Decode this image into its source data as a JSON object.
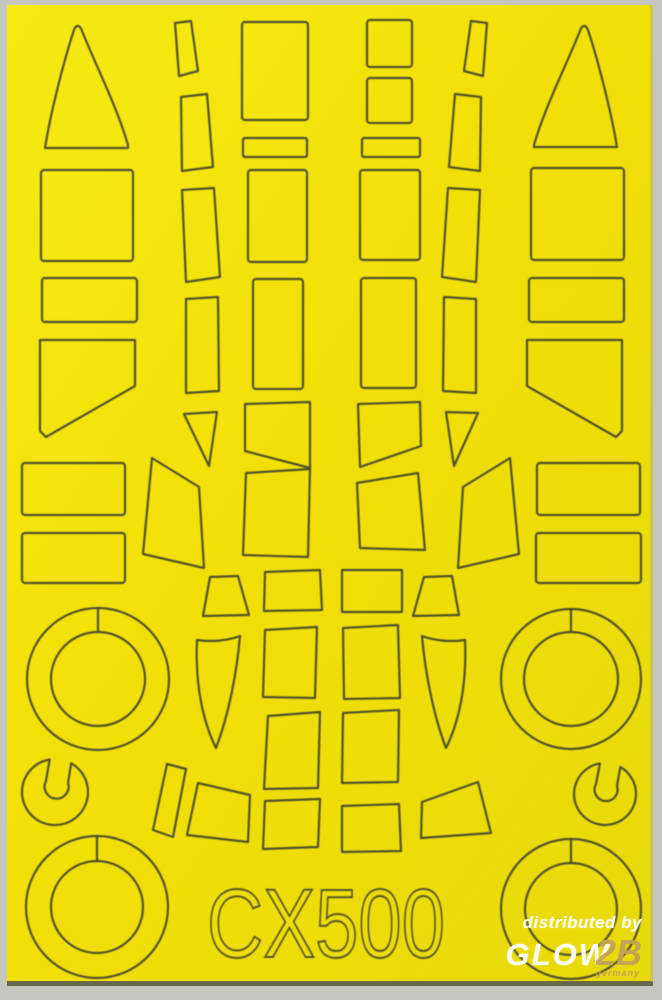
{
  "sheet": {
    "code": "CX500",
    "description": "die-cut paint mask sheet on yellow tape carrier"
  },
  "watermark": {
    "line1": "distributed by",
    "brand": "GLOW",
    "brand_suffix": "2B",
    "country": "germany"
  },
  "colors": {
    "sheet_yellow": "#f1e006",
    "sheet_yellow_light": "#f6ea14",
    "sheet_yellow_dark": "#e8d90b",
    "cut_line": "#45452c",
    "code_color": "#3e3e28",
    "scan_margin": "#c6c6c1",
    "bottom_edge": "#57573a",
    "watermark_white": "#ffffff",
    "watermark_gold": "#c2a254"
  },
  "masks": [
    {
      "name": "windscreen-triangle-left"
    },
    {
      "name": "windscreen-triangle-right"
    },
    {
      "name": "canopy-panel-rect-outer-left-1"
    },
    {
      "name": "canopy-panel-rect-outer-left-2"
    },
    {
      "name": "quarter-window-pentagon-left"
    },
    {
      "name": "fuselage-band-left-1"
    },
    {
      "name": "fuselage-band-left-2"
    },
    {
      "name": "canopy-frame-strip-left-1"
    },
    {
      "name": "canopy-frame-strip-left-2"
    },
    {
      "name": "canopy-frame-strip-left-3"
    },
    {
      "name": "canopy-frame-strip-left-4"
    },
    {
      "name": "small-triangle-left"
    },
    {
      "name": "side-glazing-quad-left"
    },
    {
      "name": "center-panel-rect-left-1"
    },
    {
      "name": "center-panel-strip-left"
    },
    {
      "name": "center-panel-rect-left-2"
    },
    {
      "name": "center-panel-rect-left-3"
    },
    {
      "name": "center-panel-slant-left"
    },
    {
      "name": "center-panel-rect-left-4"
    },
    {
      "name": "canopy-trapezoid-left"
    },
    {
      "name": "leaf-blade-mask-left"
    },
    {
      "name": "window-row1-left"
    },
    {
      "name": "window-row2-left"
    },
    {
      "name": "window-row3-left"
    },
    {
      "name": "window-row4-left"
    },
    {
      "name": "slanted-strip-bottom-left"
    },
    {
      "name": "rotated-quad-bottom-left"
    },
    {
      "name": "rotated-quad-bottom-right"
    },
    {
      "name": "wheel-hub-keyhole-left"
    },
    {
      "name": "wheel-hub-keyhole-right"
    },
    {
      "name": "wheel-donut-mid-left"
    },
    {
      "name": "wheel-donut-mid-right"
    },
    {
      "name": "wheel-donut-bottom-left"
    },
    {
      "name": "wheel-donut-bottom-right"
    },
    {
      "name": "square-panel-right-1"
    },
    {
      "name": "square-panel-right-2"
    },
    {
      "name": "center-panel-strip-right"
    },
    {
      "name": "center-panel-rect-right-1"
    },
    {
      "name": "center-panel-rect-right-2"
    },
    {
      "name": "center-panel-slant-right"
    },
    {
      "name": "center-panel-rect-right-3"
    },
    {
      "name": "canopy-frame-strip-right-1"
    },
    {
      "name": "canopy-frame-strip-right-2"
    },
    {
      "name": "canopy-frame-strip-right-3"
    },
    {
      "name": "canopy-frame-strip-right-4"
    },
    {
      "name": "small-triangle-right"
    },
    {
      "name": "side-glazing-quad-right"
    },
    {
      "name": "canopy-panel-rect-outer-right-1"
    },
    {
      "name": "canopy-panel-rect-outer-right-2"
    },
    {
      "name": "quarter-window-pentagon-right"
    },
    {
      "name": "fuselage-band-right-1"
    },
    {
      "name": "fuselage-band-right-2"
    },
    {
      "name": "canopy-trapezoid-right"
    },
    {
      "name": "leaf-blade-mask-right"
    },
    {
      "name": "window-row1-right"
    },
    {
      "name": "window-row2-right"
    },
    {
      "name": "window-row3-right"
    },
    {
      "name": "window-row4-right"
    }
  ]
}
